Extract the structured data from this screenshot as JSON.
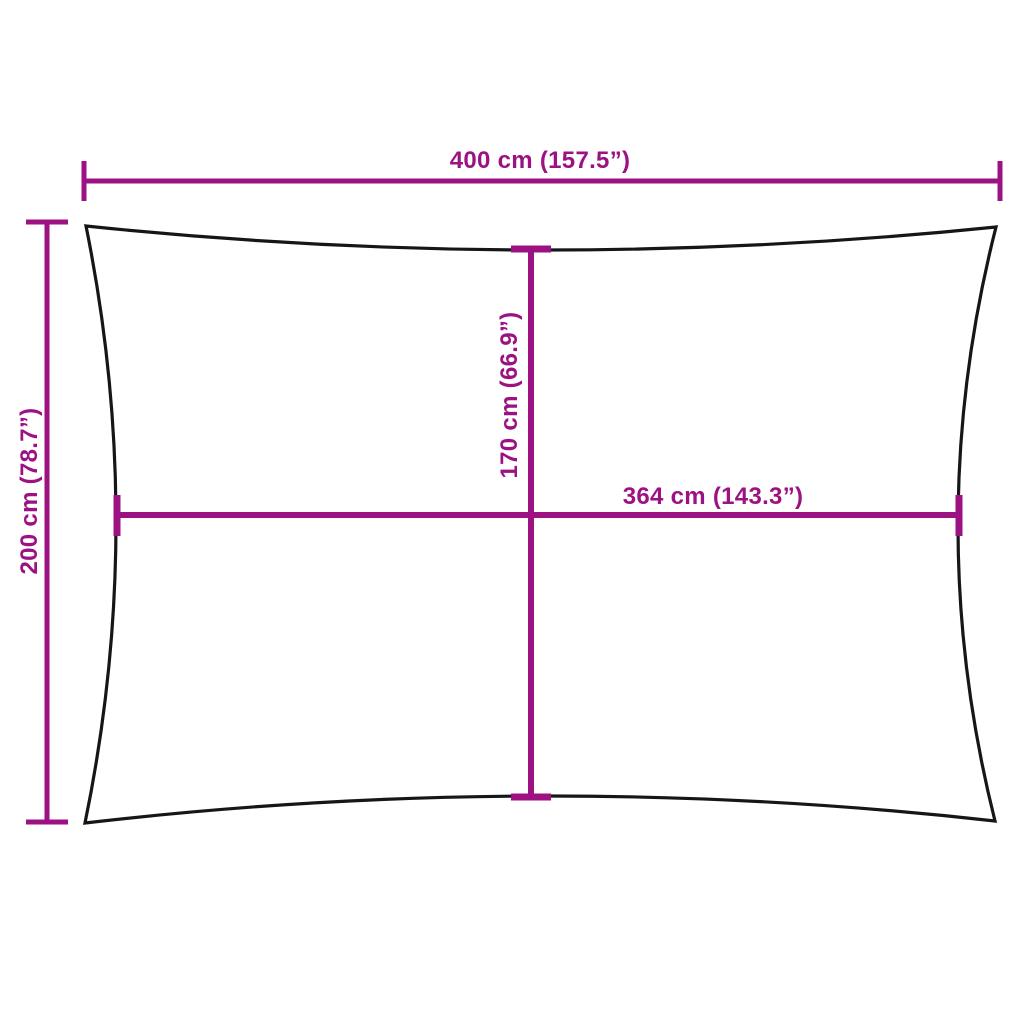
{
  "diagram": {
    "kind": "product-dimension-diagram",
    "shape": "rectangular shade sail with concave edges",
    "dimensions": {
      "top_width": {
        "label": "400 cm (157.5”)",
        "value_cm": 400,
        "value_in": 157.5,
        "orientation": "horizontal",
        "position": "top edge, full width"
      },
      "left_height": {
        "label": "200 cm (78.7”)",
        "value_cm": 200,
        "value_in": 78.7,
        "orientation": "vertical",
        "position": "left edge, full height"
      },
      "center_height": {
        "label": "170 cm (66.9”)",
        "value_cm": 170,
        "value_in": 66.9,
        "orientation": "vertical",
        "position": "center, between concave top and bottom edges"
      },
      "center_width": {
        "label": "364 cm (143.3”)",
        "value_cm": 364,
        "value_in": 143.3,
        "orientation": "horizontal",
        "position": "center, between concave left and right edges"
      }
    }
  },
  "colors": {
    "accent": "#9C1283",
    "outline": "#161616",
    "background": "#ffffff"
  }
}
